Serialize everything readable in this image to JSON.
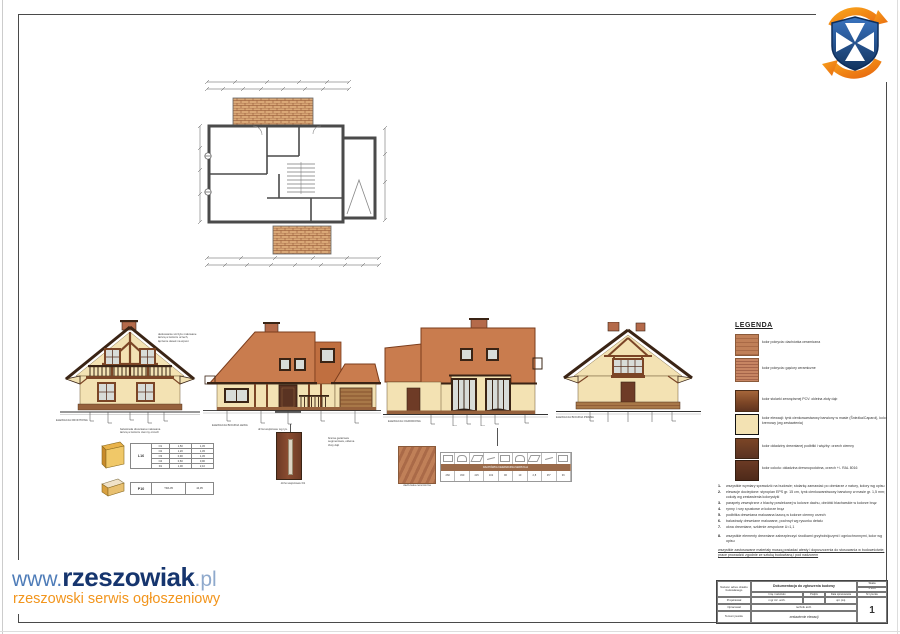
{
  "colors": {
    "roof": "#c97c4e",
    "wall": "#f3e2b3",
    "trim": "#3a2415",
    "wood": "#7b4526",
    "woodlight": "#a87848",
    "plinth": "#96613c",
    "brick": "#b46a4a",
    "glass": "#d8dcd8",
    "accent-blue": "#16356e",
    "accent-blue-light": "#4e7cb8",
    "accent-orange": "#f2951d",
    "logo-blue": "#1f4e8c",
    "logo-orange": "#f07818"
  },
  "watermark": {
    "www": "www.",
    "name": "rzeszowiak",
    "tld": ".pl",
    "subtitle": "rzeszowski serwis ogłoszeniowy"
  },
  "elevations": [
    {
      "label": "ELEWACJA FRONTOWA"
    },
    {
      "label": "ELEWACJA BOCZNA LEWA"
    },
    {
      "label": "ELEWACJA OGRODOWA"
    },
    {
      "label": "ELEWACJA BOCZNA PRAWA"
    }
  ],
  "annotations": [
    {
      "text": "deskowanie szczytu malowane\nlazurą w kolorze orzech,\nłączenie desek na wpust"
    },
    {
      "text": "balustrada drewniana malowana\nlazurą w kolorze ciemny orzech"
    },
    {
      "text": "drzwi wejściowe wg rys."
    },
    {
      "text": "brama garażowa\nsegmentowa, okleina\nzłoty dąb"
    }
  ],
  "legend": {
    "title": "LEGENDA",
    "items": [
      {
        "label": "kolor pokrycia: dachówka ceramiczna"
      },
      {
        "label": "kolor pokrycia: gąsiory ceramiczne"
      },
      {
        "label": "kolor stolarki zewnętrznej PCV: okleina złoty dąb"
      },
      {
        "label": "kolor elewacji: tynk cienkowarstwowy barwiony w masie (Śnieżka/Caparol), kolor kremowy (wg zestawienia)"
      },
      {
        "label": "kolor okładziny drewnianej podbitki i więźby: orzech ciemny"
      },
      {
        "label": "kolor cokołu: okładzina drewnopodobna, orzech +/- RAL 8016"
      }
    ]
  },
  "notes": {
    "items": [
      {
        "num": "1.",
        "text": "wszystkie wymiary sprawdzić na budowie; stolarkę zamawiać po obmiarze z natury, kolory wg opisu"
      },
      {
        "num": "2.",
        "text": "elewacje docieplone: styropian EPS gr. 15 cm, tynk cienkowarstwowy barwiony w masie gr. 1,5 mm; cokoły wg zestawienia kolorystyki"
      },
      {
        "num": "3.",
        "text": "parapety zewnętrzne z blachy powlekanej w kolorze dachu, obróbki blacharskie w kolorze brąz"
      },
      {
        "num": "4.",
        "text": "rynny i rury spustowe w kolorze brąz"
      },
      {
        "num": "5.",
        "text": "podbitka drewniana malowana lazurą w kolorze ciemny orzech"
      },
      {
        "num": "6.",
        "text": "balustrady drewniane malowane, pochwyt wg rysunku detalu"
      },
      {
        "num": "7.",
        "text": "okna drewniane, szklenie zespolone U=1,1"
      },
      {
        "num": "8.",
        "text": "wszystkie elementy drewniane zabezpieczyć środkami grzybobójczymi i ogniochronnymi, kolor wg opisu"
      }
    ],
    "footer": "wszystkie zastosowane materiały muszą posiadać atesty i dopuszczenia do stosowania w budownictwie; prace prowadzić zgodnie ze sztuką budowlaną i pod nadzorem"
  },
  "details": {
    "door_caption": "drzwi wejściowe D1",
    "tile_caption": "dachówka ceramiczna",
    "l16": {
      "label": "L16",
      "rows": [
        [
          "O1",
          "1,50",
          "1,45"
        ],
        [
          "O2",
          "1,20",
          "1,45"
        ],
        [
          "O3",
          "0,90",
          "1,45"
        ],
        [
          "O4",
          "0,60",
          "0,90"
        ],
        [
          "D1",
          "1,00",
          "2,10"
        ]
      ]
    },
    "p10": [
      "P10",
      "TRA 05",
      "44,05"
    ]
  },
  "tile_table": {
    "band": "DACHÓWKA CERAMICZNA MARSYLIA",
    "values": [
      "260",
      "330",
      "415",
      "102",
      "96",
      "10",
      "2,8",
      "45°",
      "36"
    ]
  },
  "title_block": {
    "object_label": "Nazwa i adres obiektu budowlanego",
    "doc_title": "Dokumentacja do zgłoszenia budowy",
    "scale_label": "Skala",
    "scale": "1:100",
    "col_name": "Imię i nazwisko",
    "col_sign": "Podpis",
    "col_date": "Data opracowania",
    "drawing_no_label": "Nr rysunku",
    "row1_label": "Projektował",
    "row1_name": "mgr inż. arch.",
    "row1_cert": "upr. proj.",
    "row2_label": "Opracował",
    "row2_value": "technik arch.",
    "subject_label": "Temat rysunku",
    "subject": "zestawienie elewacji",
    "drawing_no": "1"
  }
}
